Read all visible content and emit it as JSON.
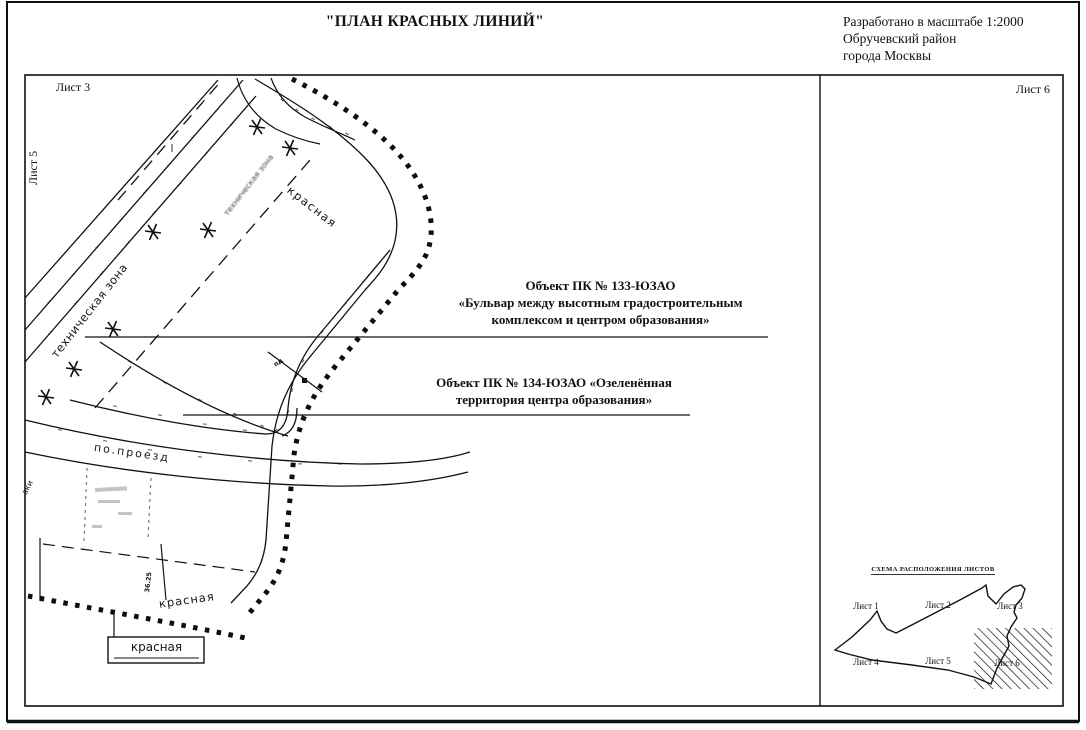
{
  "page": {
    "title": "\"ПЛАН КРАСНЫХ ЛИНИЙ\"",
    "header_right": {
      "line1": "Разработано в масштабе 1:2000",
      "line2": "Обручевский район",
      "line3": "города  Москвы"
    }
  },
  "sheets": {
    "top_left": "Лист 3",
    "left_edge": "Лист 5",
    "top_right": "Лист 6"
  },
  "annotations": {
    "krasnaya": "красная",
    "tech_zone": "техническая зона",
    "proezd": "по.проезд",
    "dim": "36.25",
    "pd": "пд",
    "aki": "аки"
  },
  "callouts": {
    "obj133": {
      "line1": "Объект ПК № 133-ЮЗАО",
      "line2": "«Бульвар между высотным градостроительным",
      "line3": "комплексом и центром образования»"
    },
    "obj134": {
      "line1": "Объект ПК № 134-ЮЗАО «Озеленённая",
      "line2": "территория центра образования»"
    }
  },
  "index_map": {
    "title": "СХЕМА РАСПОЛОЖЕНИЯ ЛИСТОВ",
    "sheets": [
      "Лист 1",
      "Лист 2",
      "Лист 3",
      "Лист 4",
      "Лист 5",
      "Лист 6"
    ]
  },
  "colors": {
    "ink": "#111111",
    "paper": "#ffffff"
  }
}
